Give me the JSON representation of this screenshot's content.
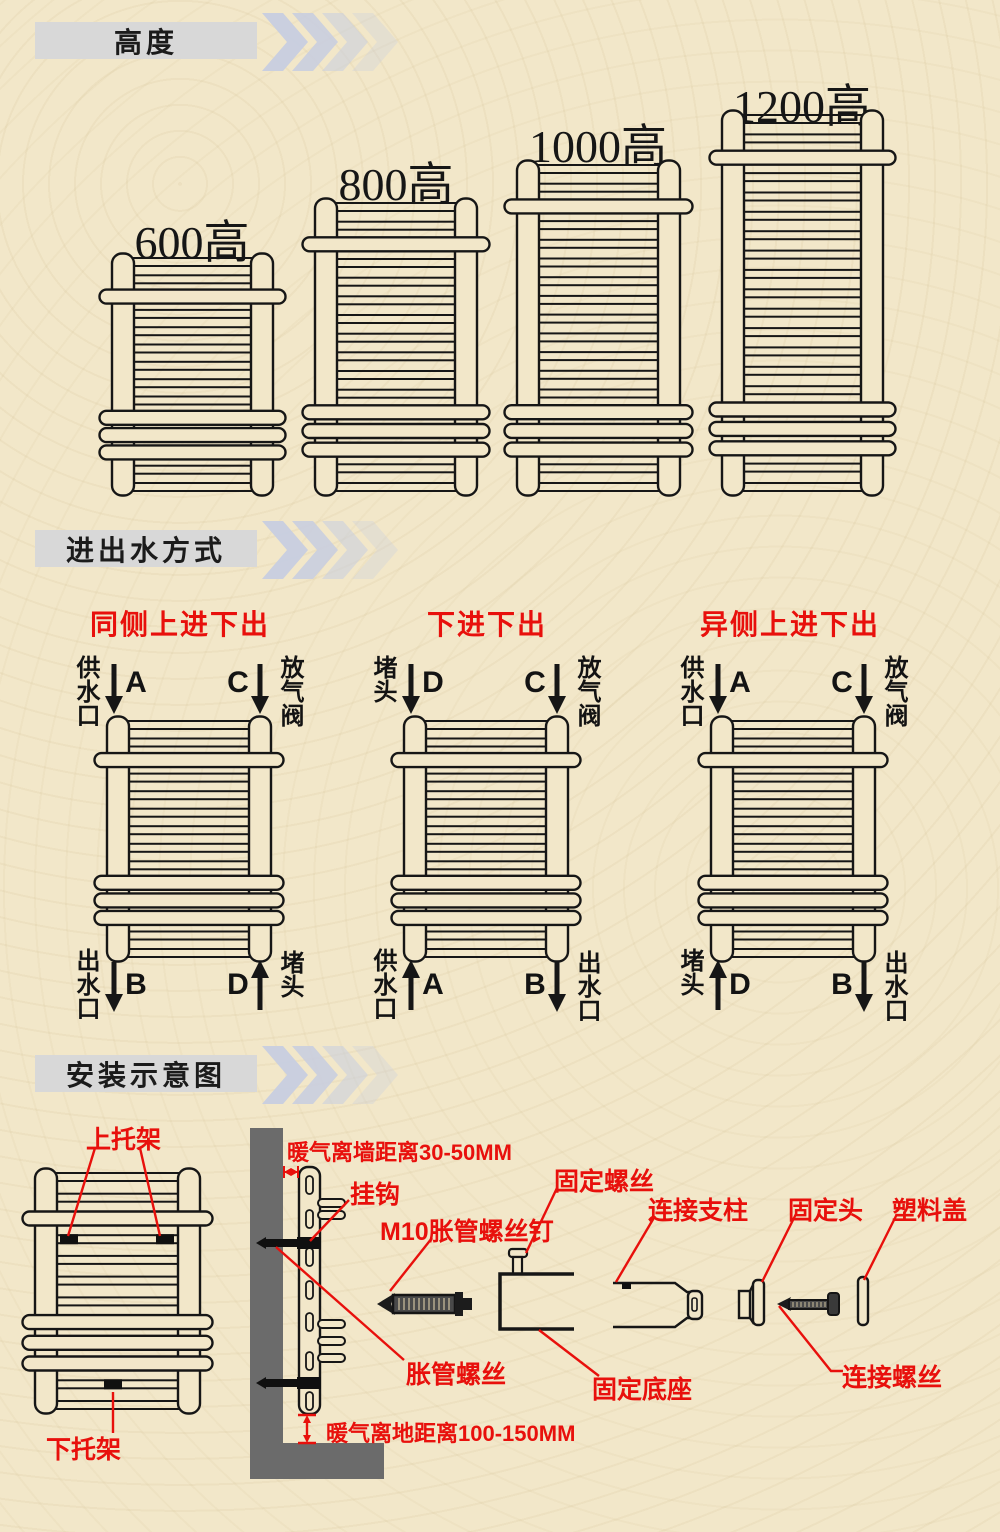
{
  "colors": {
    "background": "#f2e7c9",
    "line": "#161616",
    "accent_red": "#e8100c",
    "header_bar": "#d8d8d8",
    "chevron": "#c7cde0",
    "wall_gray": "#6b6b6b",
    "bracket_black": "#101010"
  },
  "sections": {
    "height": {
      "header": "高度",
      "models": [
        {
          "label": "600高",
          "rungs": 14
        },
        {
          "label": "800高",
          "rungs": 16
        },
        {
          "label": "1000高",
          "rungs": 18
        },
        {
          "label": "1200高",
          "rungs": 20
        }
      ]
    },
    "flow": {
      "header": "进出水方式",
      "diagrams": [
        {
          "title": "同侧上进下出",
          "corners": {
            "tl": {
              "label": "供水口",
              "letter": "A",
              "dir": "down"
            },
            "tr": {
              "label": "放气阀",
              "letter": "C",
              "dir": "down"
            },
            "bl": {
              "label": "出水口",
              "letter": "B",
              "dir": "down"
            },
            "br": {
              "label": "堵头",
              "letter": "D",
              "dir": "up"
            }
          }
        },
        {
          "title": "下进下出",
          "corners": {
            "tl": {
              "label": "堵头",
              "letter": "D",
              "dir": "down"
            },
            "tr": {
              "label": "放气阀",
              "letter": "C",
              "dir": "down"
            },
            "bl": {
              "label": "供水口",
              "letter": "A",
              "dir": "up"
            },
            "br": {
              "label": "出水口",
              "letter": "B",
              "dir": "down"
            }
          }
        },
        {
          "title": "异侧上进下出",
          "corners": {
            "tl": {
              "label": "供水口",
              "letter": "A",
              "dir": "down"
            },
            "tr": {
              "label": "放气阀",
              "letter": "C",
              "dir": "down"
            },
            "bl": {
              "label": "堵头",
              "letter": "D",
              "dir": "up"
            },
            "br": {
              "label": "出水口",
              "letter": "B",
              "dir": "down"
            }
          }
        }
      ]
    },
    "install": {
      "header": "安装示意图",
      "labels": {
        "upper_bracket": "上托架",
        "lower_bracket": "下托架",
        "wall_distance": "暖气离墙距离30-50MM",
        "hook": "挂钩",
        "m10_screw": "M10胀管螺丝钉",
        "expansion_screw": "胀管螺丝",
        "floor_distance": "暖气离地距离100-150MM",
        "fixing_screw": "固定螺丝",
        "fixing_base": "固定底座",
        "connecting_pillar": "连接支柱",
        "fixing_head": "固定头",
        "connecting_screw": "连接螺丝",
        "plastic_cover": "塑料盖"
      }
    }
  }
}
